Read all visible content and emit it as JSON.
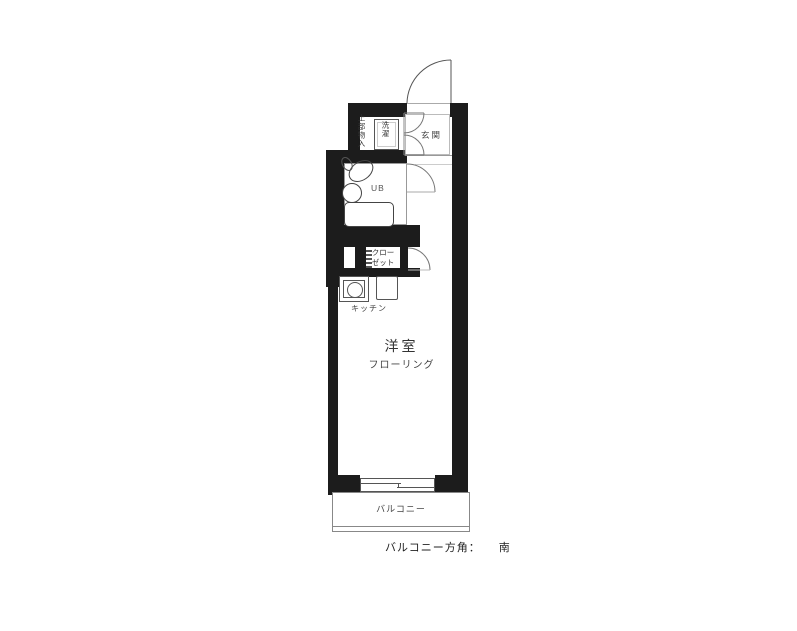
{
  "page": {
    "caption": {
      "label": "バルコニー方角：",
      "value": "南"
    }
  },
  "floorplan": {
    "rooms": {
      "entrance": {
        "label": "玄関"
      },
      "upper_storage": {
        "label": "上部物入"
      },
      "washer": {
        "label": "洗濯"
      },
      "bathroom": {
        "label": "UB"
      },
      "closet": {
        "label_line1": "クロー",
        "label_line2": "ゼット"
      },
      "kitchen": {
        "label": "キッチン"
      },
      "main_room": {
        "label": "洋室",
        "sublabel": "フローリング"
      },
      "balcony": {
        "label": "バルコニー"
      }
    },
    "colors": {
      "wall": "#1c1c1c",
      "line": "#777777",
      "text": "#333333"
    }
  }
}
